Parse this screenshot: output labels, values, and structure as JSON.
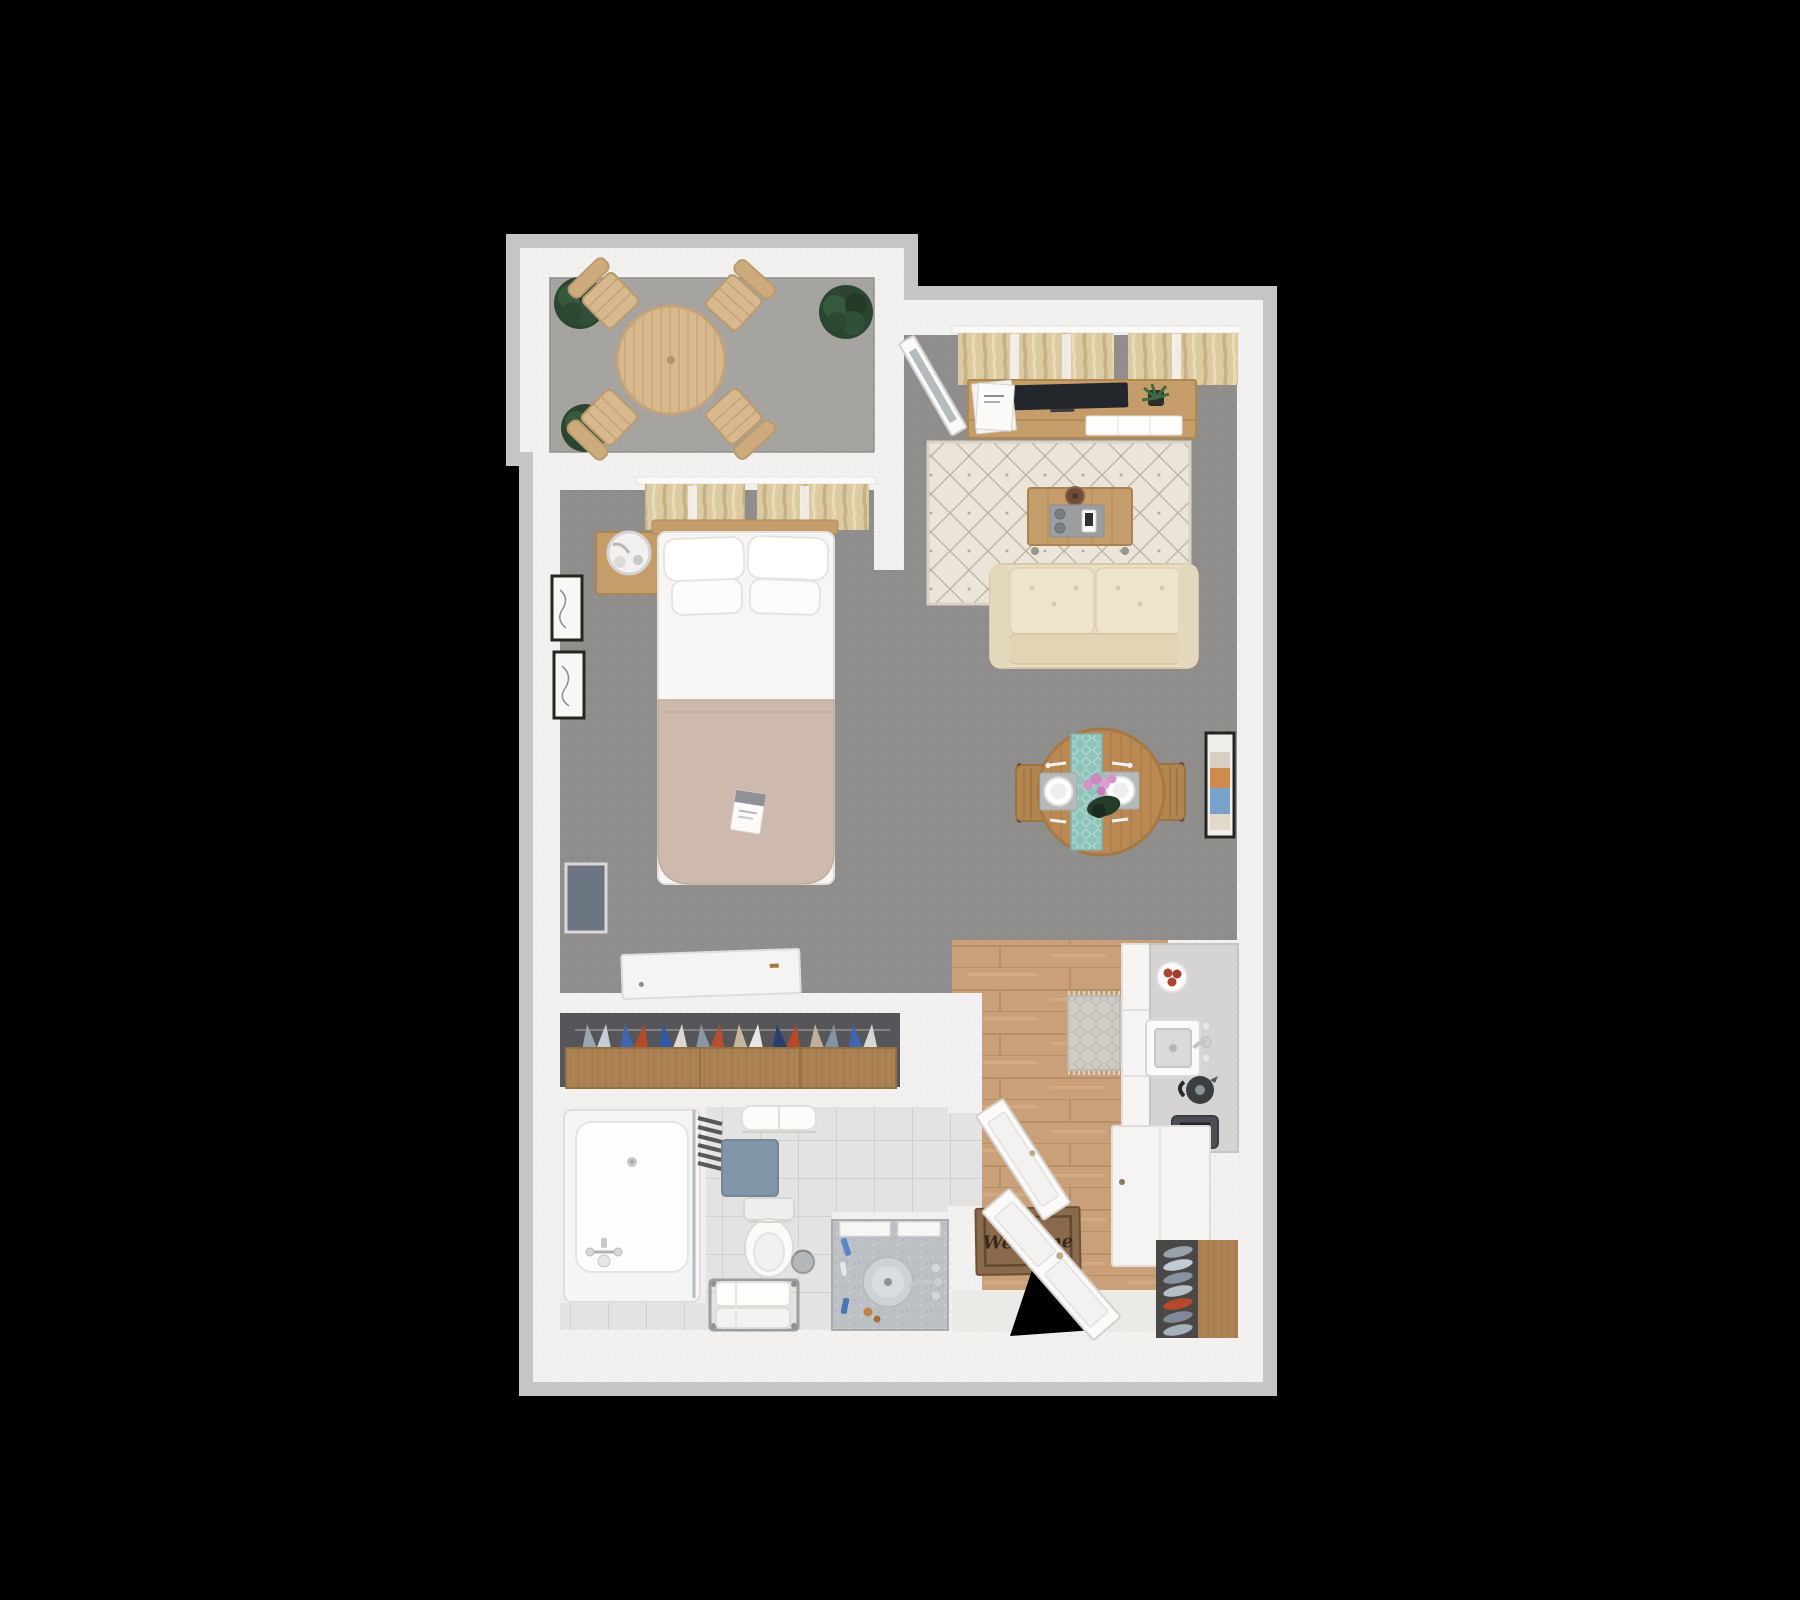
{
  "scene": {
    "type": "3d-floorplan-top-down-render",
    "background": "#000000",
    "welcome_mat_text": "Welcome"
  },
  "palette": {
    "wall": "#f2f1ef",
    "outer_trim": "#c6c5c3",
    "studio_carpet": "#8f8e8c",
    "balcony_floor": "#a6a4a1",
    "kitchen_wood_floor": "#c9a077",
    "bathroom_tile": "#e4e3e1",
    "furniture_wood": "#c59d6b",
    "patio_wood": "#d8b98d",
    "dining_wood": "#bb8a54",
    "sofa_cream": "#e9dec6",
    "bed_blanket_taupe": "#cdbaac",
    "table_runner_teal": "#8fc4ba",
    "bath_mat_blue": "#8095a6",
    "welcome_mat_brown": "#8a6a4c",
    "plant_green": "#2b4530",
    "tv_screen": "#23262a",
    "closet_interior": "#56565a"
  },
  "rooms": [
    {
      "name": "balcony",
      "furniture": [
        "round-patio-table",
        "patio-chair x4",
        "potted-plant x3"
      ]
    },
    {
      "name": "living-room",
      "furniture": [
        "window-curtains",
        "tv-console",
        "television",
        "magazine-stack",
        "console-plant",
        "area-rug",
        "coffee-table",
        "serving-tray",
        "sofa",
        "wall-art"
      ]
    },
    {
      "name": "bedroom",
      "furniture": [
        "window-curtains",
        "nightstand",
        "table-lamp",
        "double-bed",
        "pillows x4",
        "magazine",
        "wall-frame x2",
        "wall-panel",
        "wall-desk",
        "balcony-glass-door"
      ]
    },
    {
      "name": "dining-area",
      "furniture": [
        "round-dining-table",
        "table-runner",
        "place-setting x2",
        "flower-centerpiece",
        "dining-chair x2"
      ]
    },
    {
      "name": "closet",
      "furniture": [
        "hanging-clothes",
        "drawer-unit"
      ]
    },
    {
      "name": "bathroom",
      "furniture": [
        "bathtub",
        "glass-screen",
        "towel-radiator",
        "rolled-towels",
        "bath-mat",
        "toilet",
        "towel-bench",
        "trash-bin",
        "vanity-counter",
        "round-sink"
      ]
    },
    {
      "name": "kitchen-entry",
      "furniture": [
        "wood-floor-mat",
        "kitchen-counter",
        "tomato-plate",
        "kitchen-sink",
        "kettle",
        "toaster",
        "entry-cabinet",
        "shoe-rack",
        "welcome-mat",
        "bathroom-door",
        "entry-door"
      ]
    }
  ]
}
